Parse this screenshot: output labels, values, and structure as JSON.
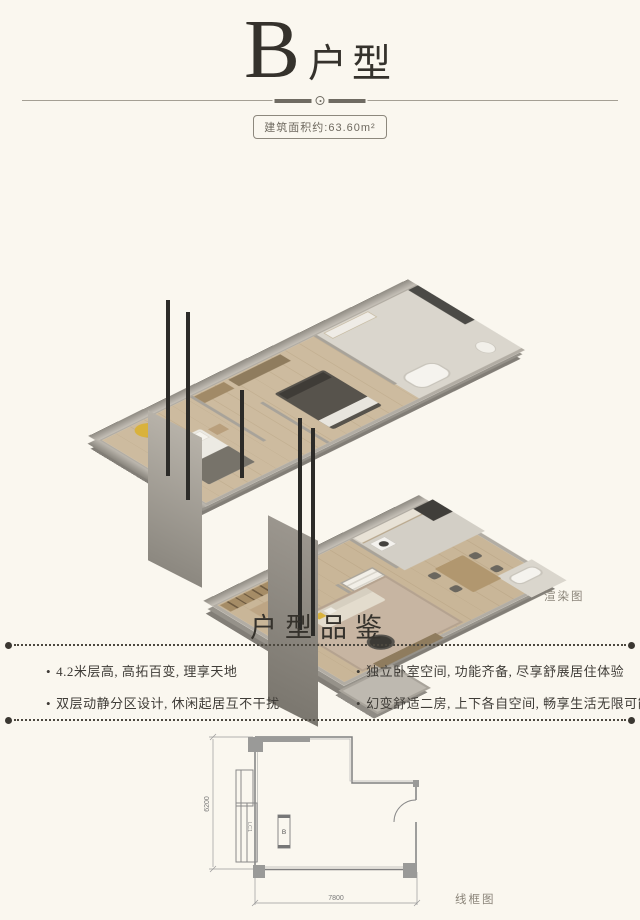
{
  "title": {
    "letter": "B",
    "suffix": "户型"
  },
  "area_badge": {
    "label": "建筑面积约:63.60m²"
  },
  "render_figure": {
    "caption": "渲染图"
  },
  "features": {
    "heading": "户型品鉴",
    "bullet": "•",
    "left": [
      "4.2米层高, 高拓百变, 理享天地",
      "双层动静分区设计, 休闲起居互不干扰"
    ],
    "right": [
      "独立卧室空间, 功能齐备, 尽享舒展居住体验",
      "幻变舒适二房, 上下各自空间, 畅享生活无限可能"
    ]
  },
  "wireframe": {
    "caption": "线框图",
    "width_dim": "7800",
    "height_dim": "6200",
    "unit_mark": "B",
    "window_tag": "LC1"
  },
  "colors": {
    "background": "#faf7ef",
    "ink": "#35322c",
    "muted": "#8b857a",
    "accent_yellow": "#d9b23c",
    "wall_gray": "#b2ada4",
    "wood_floor": "#cdbb9f",
    "dark_furniture": "#3c3a35"
  }
}
